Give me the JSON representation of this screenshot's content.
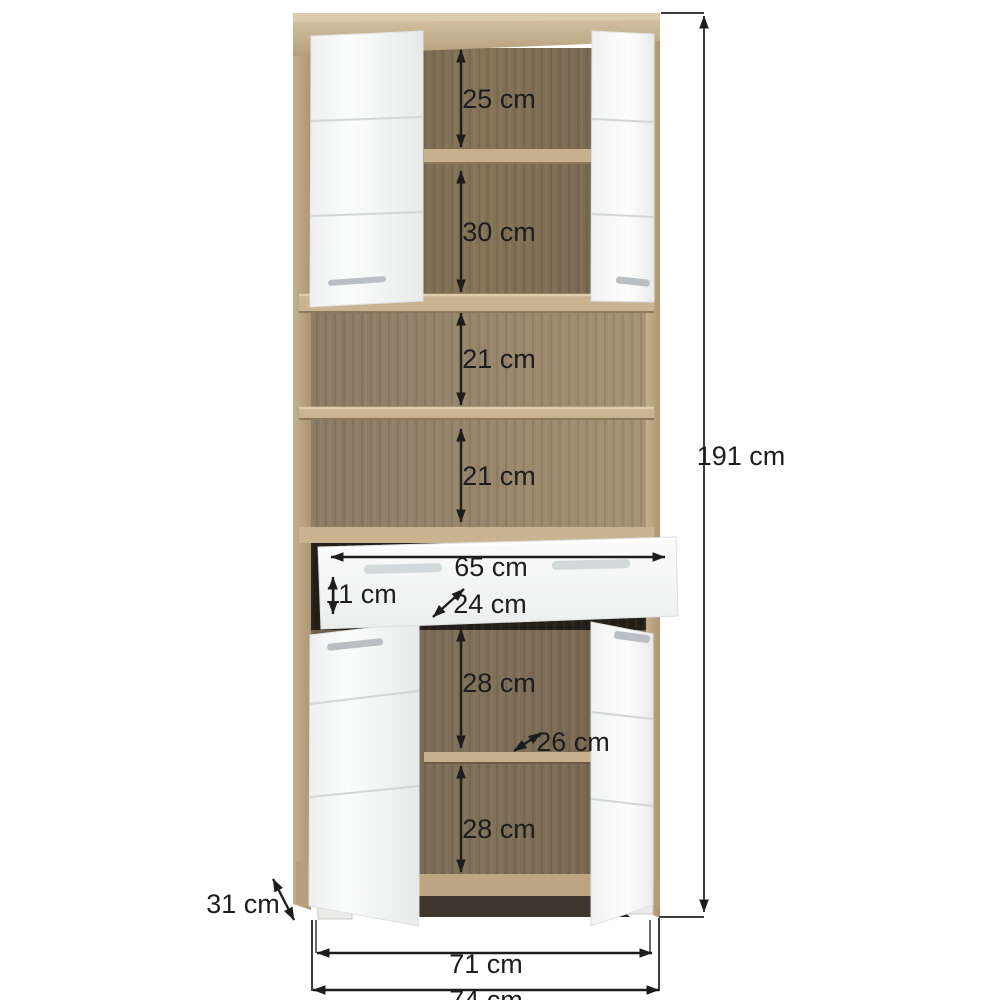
{
  "page": {
    "background": "#ffffff",
    "kind": "furniture-dimension-diagram"
  },
  "labels": {
    "shelf_25": "25 cm",
    "shelf_30": "30 cm",
    "niche_21_top": "21 cm",
    "niche_21_bottom": "21 cm",
    "drawer_width": "65 cm",
    "drawer_height": "11 cm",
    "drawer_depth": "24 cm",
    "lower_28_top": "28 cm",
    "lower_depth_26": "26 cm",
    "lower_28_bottom": "28 cm",
    "overall_height": "191 cm",
    "overall_depth": "31 cm",
    "width_inner": "71 cm",
    "width_overall": "74 cm"
  },
  "dimensions_cm": {
    "overall_height": 191,
    "overall_width": 74,
    "overall_depth": 31,
    "feet_span_width": 71,
    "top_cabinet_compartments": [
      25,
      30
    ],
    "open_niches": [
      21,
      21
    ],
    "drawer": {
      "width": 65,
      "front_height": 11,
      "inner_depth": 24
    },
    "lower_cabinet_compartments": [
      28,
      28
    ],
    "lower_inner_depth": 26
  },
  "colors": {
    "oak_light": "#cdb896",
    "oak_mid": "#b9a17f",
    "interior_dark": "#7a6a54",
    "niche_back": "#8d7d66",
    "door_white": "#f5f6f6",
    "handle_gray": "#c6cccd",
    "dimension_ink": "#1d1d1d"
  }
}
